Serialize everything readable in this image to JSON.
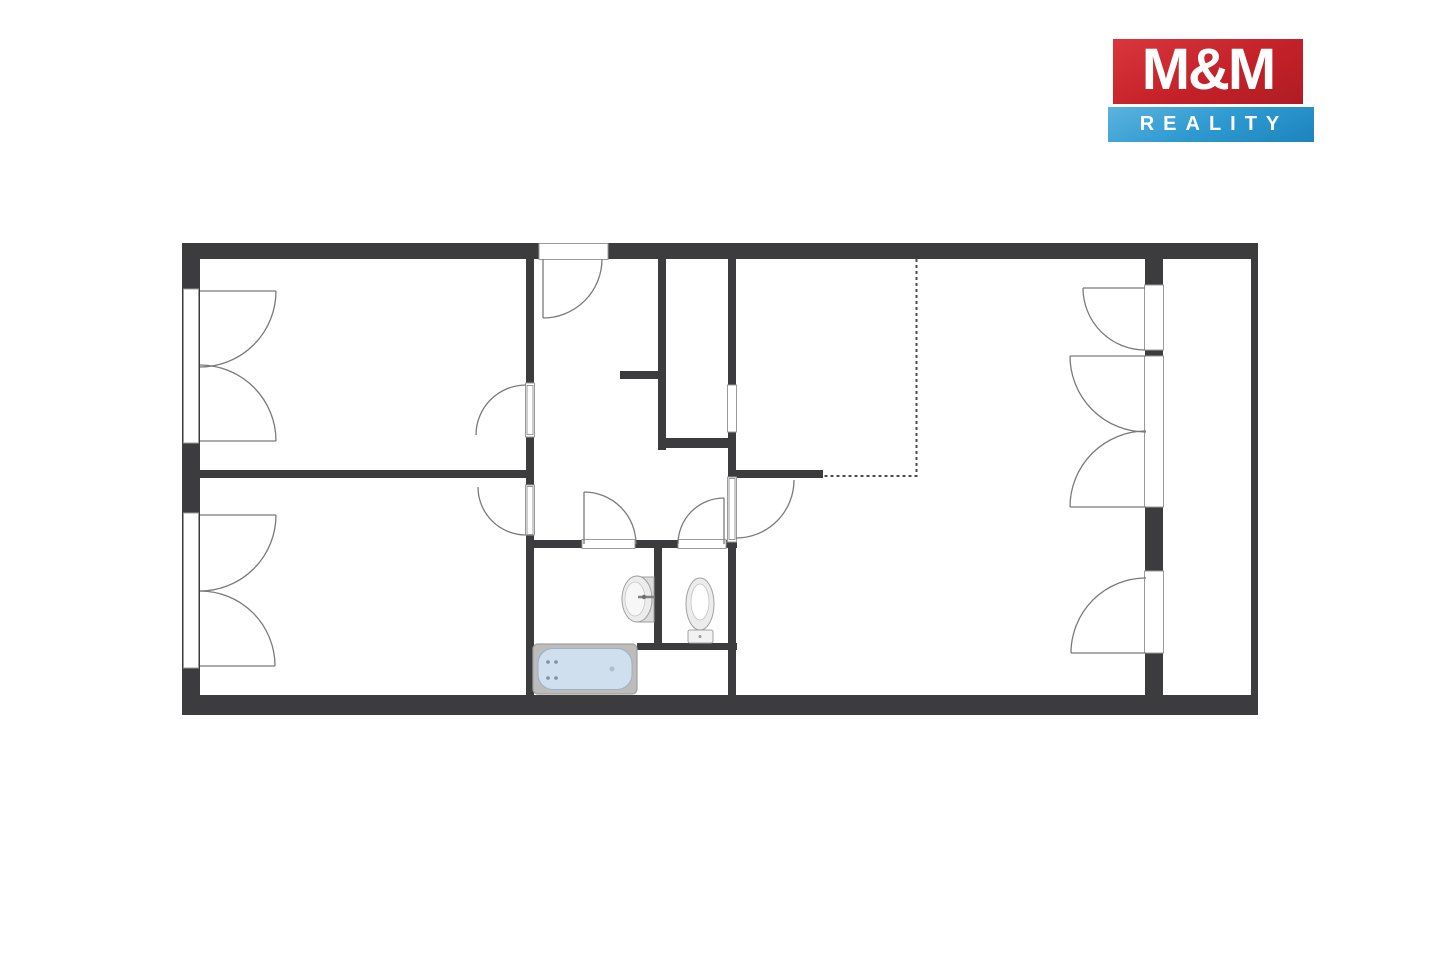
{
  "logo": {
    "title": "M&M",
    "subtitle": "REALITY"
  },
  "colors": {
    "background": "#ffffff",
    "logo_red": "#c42128",
    "logo_red_light": "#d9363d",
    "logo_blue": "#2e9ad1",
    "logo_blue_light": "#5cb3de",
    "logo_text": "#ffffff",
    "wall": "#3c3c3e",
    "opening_stroke": "#9b9b9b",
    "arc": "#7a7a7a",
    "dashed_line": "#4c4c4c",
    "tub_rim": "#bcbcbc",
    "tub_fill": "#cfdfee",
    "fixture_fill": "#ececec",
    "fixture_stroke": "#a0a0a0"
  },
  "floorplan": {
    "fixtures": [
      "bathtub",
      "washbasin",
      "toilet"
    ],
    "features": [
      "entrance-door",
      "french-window-1",
      "french-window-2",
      "balcony-door-top",
      "balcony-double-door",
      "balcony-door-bottom",
      "kitchen-zone-dashed-line"
    ]
  }
}
